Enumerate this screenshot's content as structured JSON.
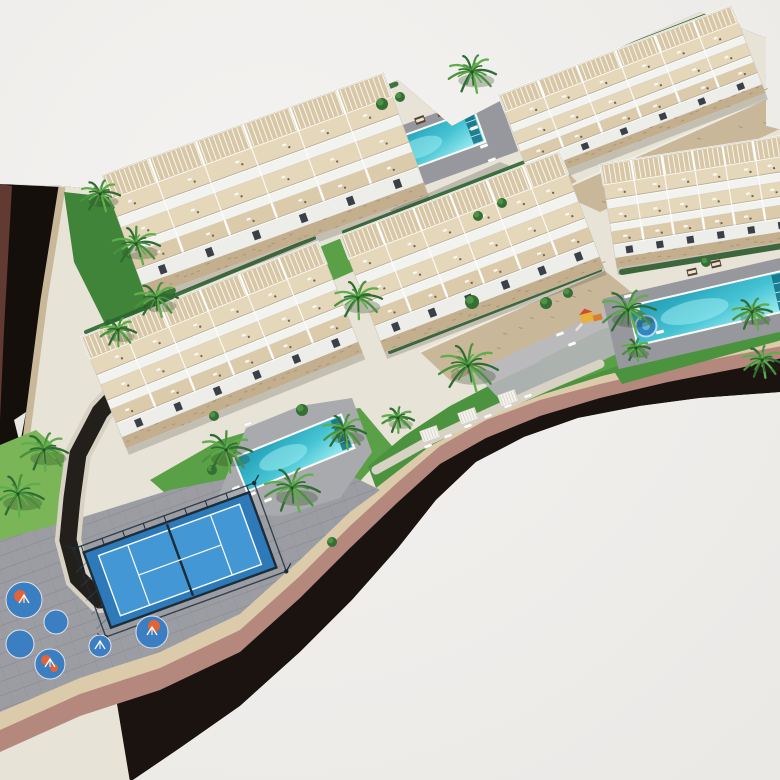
{
  "scene": {
    "canvas": {
      "w": 780,
      "h": 780
    },
    "palette": {
      "bg": "#f4f3f1",
      "bg2": "#ebe9e6",
      "siteBase": "#e8e3d7",
      "asphalt": "#1a1310",
      "mauve": "#b5887e",
      "beige": "#dccbab",
      "stone": "#c9b79a",
      "stoneDark": "#a08e72",
      "stoneCap": "#f0ece2",
      "lawn": "#4c9340",
      "lawnLight": "#7ab557",
      "lawnMid": "#5aa046",
      "hedge": "#2d6630",
      "hedgeStrip": "#3f8438",
      "paving": "#9c9da3",
      "pavingLine": "#84858c",
      "deck": "#97989d",
      "deckLight": "#a9aaae",
      "poolDark": "#1f9ab4",
      "poolMid": "#45c3d3",
      "poolLight": "#a5f0f4",
      "white": "#fbfbf9",
      "pergola": "#d7c7a6",
      "terrace": "#e5d7b9",
      "terrace2": "#dccbab",
      "wall": "#f2f2ef",
      "front": "#ededea",
      "window": "#3b4046",
      "stoneBase": "#c3ae8e",
      "court": "#2e79b8",
      "courtIn": "#4397d4",
      "courtFrame": "#1c2c38",
      "padBlue": "#3b7ec2",
      "padOrange": "#e06438",
      "drive": "#23201c",
      "path": "#d8d2c4",
      "parcel": "#150f0c",
      "parcelEdge": "#6e4238",
      "palmA": "#2f6b33",
      "palmB": "#49903f",
      "palmC": "#5fae4a",
      "trunk": "#8a7155",
      "daybed": "#57432f",
      "playYellow": "#e9b13d",
      "playRed": "#cf4b32",
      "playOrange": "#d87f2f",
      "splash": "#2f86c0",
      "splashIn": "#67b4e0"
    },
    "road": {
      "outer": [
        [
          130,
          782
        ],
        [
          180,
          748
        ],
        [
          240,
          706
        ],
        [
          300,
          652
        ],
        [
          352,
          600
        ],
        [
          398,
          548
        ],
        [
          436,
          500
        ],
        [
          476,
          462
        ],
        [
          524,
          437
        ],
        [
          578,
          418
        ],
        [
          640,
          406
        ],
        [
          700,
          398
        ],
        [
          782,
          392
        ]
      ],
      "asphalt_top": [
        [
          0,
          752
        ],
        [
          80,
          716
        ],
        [
          160,
          690
        ],
        [
          240,
          652
        ],
        [
          300,
          598
        ],
        [
          350,
          548
        ],
        [
          398,
          502
        ],
        [
          440,
          464
        ],
        [
          486,
          438
        ],
        [
          540,
          416
        ],
        [
          600,
          398
        ],
        [
          668,
          382
        ],
        [
          740,
          368
        ],
        [
          782,
          358
        ]
      ],
      "mauve_top": [
        [
          0,
          730
        ],
        [
          80,
          694
        ],
        [
          160,
          668
        ],
        [
          240,
          630
        ],
        [
          300,
          576
        ],
        [
          350,
          526
        ],
        [
          398,
          482
        ],
        [
          440,
          446
        ],
        [
          486,
          420
        ],
        [
          540,
          400
        ],
        [
          600,
          384
        ],
        [
          668,
          368
        ],
        [
          740,
          354
        ],
        [
          782,
          346
        ]
      ],
      "beige_top": [
        [
          0,
          712
        ],
        [
          80,
          678
        ],
        [
          160,
          652
        ],
        [
          240,
          614
        ],
        [
          300,
          560
        ],
        [
          350,
          512
        ],
        [
          398,
          468
        ],
        [
          440,
          434
        ],
        [
          486,
          408
        ],
        [
          540,
          390
        ],
        [
          600,
          374
        ],
        [
          668,
          358
        ],
        [
          740,
          344
        ],
        [
          782,
          336
        ]
      ]
    },
    "site_upper": [
      [
        0,
        184
      ],
      [
        62,
        186
      ],
      [
        118,
        192
      ],
      [
        398,
        80
      ],
      [
        452,
        126
      ],
      [
        506,
        98
      ],
      [
        700,
        12
      ],
      [
        766,
        38
      ],
      [
        766,
        126
      ],
      [
        782,
        130
      ]
    ],
    "parcel": {
      "pts": [
        [
          0,
          184
        ],
        [
          62,
          187
        ],
        [
          44,
          300
        ],
        [
          26,
          440
        ],
        [
          14,
          470
        ],
        [
          0,
          490
        ]
      ],
      "edge": [
        [
          0,
          184
        ],
        [
          12,
          186
        ],
        [
          4,
          330
        ],
        [
          0,
          420
        ]
      ],
      "zigzags": [
        [
          [
            6,
            452
          ],
          [
            20,
            442
          ],
          [
            12,
            472
          ]
        ],
        [
          [
            14,
            420
          ],
          [
            26,
            412
          ],
          [
            20,
            444
          ]
        ]
      ]
    },
    "lawns": [
      {
        "id": "hedge-strip-west",
        "c": "hedgeStrip",
        "pts": [
          [
            64,
            192
          ],
          [
            118,
            198
          ],
          [
            176,
            290
          ],
          [
            160,
            352
          ],
          [
            116,
            346
          ],
          [
            74,
            262
          ]
        ]
      },
      {
        "id": "lawn-wedge-center",
        "c": "lawnMid",
        "pts": [
          [
            160,
            312
          ],
          [
            376,
            224
          ],
          [
            406,
            248
          ],
          [
            194,
            342
          ]
        ]
      },
      {
        "id": "lawn-mound-southwest",
        "c": "lawnLight",
        "pts": [
          [
            0,
            445
          ],
          [
            36,
            430
          ],
          [
            66,
            456
          ],
          [
            74,
            508
          ],
          [
            56,
            560
          ],
          [
            18,
            582
          ],
          [
            0,
            582
          ]
        ]
      },
      {
        "id": "lawn-pool-center",
        "c": "lawnMid",
        "pts": [
          [
            150,
            480
          ],
          [
            220,
            440
          ],
          [
            300,
            416
          ],
          [
            360,
            408
          ],
          [
            392,
            446
          ],
          [
            352,
            490
          ],
          [
            300,
            512
          ],
          [
            240,
            516
          ],
          [
            180,
            506
          ]
        ]
      },
      {
        "id": "lawn-main-south",
        "c": "lawn",
        "pts": [
          [
            376,
            488
          ],
          [
            430,
            446
          ],
          [
            488,
            416
          ],
          [
            544,
            394
          ],
          [
            602,
            376
          ],
          [
            668,
            360
          ],
          [
            740,
            346
          ],
          [
            782,
            338
          ],
          [
            782,
            300
          ],
          [
            720,
            300
          ],
          [
            660,
            316
          ],
          [
            610,
            330
          ],
          [
            560,
            352
          ],
          [
            500,
            380
          ],
          [
            450,
            406
          ],
          [
            404,
            436
          ],
          [
            368,
            466
          ]
        ]
      },
      {
        "id": "lawn-mini-playground",
        "c": "lawnMid",
        "pts": [
          [
            540,
            360
          ],
          [
            600,
            330
          ],
          [
            660,
            312
          ],
          [
            700,
            310
          ],
          [
            712,
            330
          ],
          [
            660,
            352
          ],
          [
            600,
            372
          ],
          [
            552,
            388
          ]
        ]
      },
      {
        "id": "lawn-east-pool",
        "c": "lawn",
        "pts": [
          [
            612,
            368
          ],
          [
            782,
            318
          ],
          [
            782,
            340
          ],
          [
            622,
            384
          ]
        ]
      }
    ],
    "esplanade": [
      [
        0,
        540
      ],
      [
        80,
        518
      ],
      [
        170,
        490
      ],
      [
        262,
        472
      ],
      [
        332,
        466
      ],
      [
        380,
        490
      ],
      [
        350,
        512
      ],
      [
        300,
        560
      ],
      [
        240,
        614
      ],
      [
        160,
        652
      ],
      [
        80,
        678
      ],
      [
        0,
        712
      ]
    ],
    "paved": [
      {
        "id": "courtyard-north",
        "c": "#b7b2a8",
        "pts": [
          [
            390,
            210
          ],
          [
            500,
            162
          ],
          [
            540,
            178
          ],
          [
            430,
            250
          ]
        ]
      },
      {
        "id": "walkway-southeast",
        "c": "#b5b5ba",
        "pts": [
          [
            470,
            368
          ],
          [
            600,
            306
          ],
          [
            648,
            338
          ],
          [
            508,
            408
          ]
        ]
      }
    ],
    "walls": [
      {
        "id": "rubble-wall-1",
        "pts": [
          [
            420,
            220
          ],
          [
            556,
            160
          ],
          [
            580,
            185
          ],
          [
            444,
            248
          ]
        ]
      },
      {
        "id": "rubble-wall-2",
        "pts": [
          [
            556,
            192
          ],
          [
            768,
            98
          ],
          [
            782,
            128
          ],
          [
            600,
            212
          ]
        ]
      },
      {
        "id": "rubble-wall-3",
        "pts": [
          [
            420,
            352
          ],
          [
            604,
            270
          ],
          [
            636,
            296
          ],
          [
            452,
            382
          ]
        ]
      }
    ],
    "hedges": [
      {
        "a": [
          116,
          190
        ],
        "b": [
          396,
          84
        ],
        "w": 5
      },
      {
        "a": [
          500,
          96
        ],
        "b": [
          726,
          8
        ],
        "w": 5
      },
      {
        "a": [
          344,
          232
        ],
        "b": [
          556,
          150
        ],
        "w": 4
      },
      {
        "a": [
          86,
          332
        ],
        "b": [
          314,
          238
        ],
        "w": 4
      },
      {
        "a": [
          622,
          272
        ],
        "b": [
          782,
          246
        ],
        "w": 6
      },
      {
        "a": [
          390,
          352
        ],
        "b": [
          600,
          270
        ],
        "w": 4
      }
    ],
    "driveway": [
      [
        130,
        380
      ],
      [
        100,
        412
      ],
      [
        78,
        454
      ],
      [
        72,
        498
      ],
      [
        68,
        540
      ],
      [
        78,
        578
      ],
      [
        100,
        600
      ]
    ],
    "walkway": {
      "path": [
        [
          376,
          470
        ],
        [
          430,
          440
        ],
        [
          490,
          412
        ],
        [
          548,
          386
        ],
        [
          600,
          364
        ]
      ],
      "squares": [
        [
          430,
          434
        ],
        [
          468,
          416
        ],
        [
          508,
          398
        ]
      ]
    },
    "buildings": [
      {
        "id": "a",
        "cx": 265,
        "cy": 185,
        "w": 300,
        "h": 130,
        "rot": -20
      },
      {
        "id": "b",
        "cx": 632,
        "cy": 94,
        "w": 250,
        "h": 94,
        "rot": -21
      },
      {
        "id": "c",
        "cx": 700,
        "cy": 202,
        "w": 185,
        "h": 105,
        "rot": -9
      },
      {
        "id": "d",
        "cx": 472,
        "cy": 252,
        "w": 235,
        "h": 125,
        "rot": -21
      },
      {
        "id": "e",
        "cx": 222,
        "cy": 345,
        "w": 255,
        "h": 120,
        "rot": -22
      }
    ],
    "pools": [
      {
        "id": "pool-north",
        "deck": {
          "cx": 436,
          "cy": 147,
          "w": 152,
          "h": 64
        },
        "cx": 430,
        "cy": 144,
        "w": 106,
        "h": 34,
        "rot": -20,
        "loungers": [
          [
            474,
            128
          ],
          [
            484,
            146
          ],
          [
            492,
            160
          ],
          [
            380,
            168
          ],
          [
            396,
            176
          ]
        ],
        "daybeds": [
          [
            420,
            120
          ],
          [
            442,
            112
          ]
        ]
      },
      {
        "id": "pool-east",
        "deck": {
          "cx": 706,
          "cy": 312,
          "w": 196,
          "h": 72
        },
        "cx": 710,
        "cy": 308,
        "w": 158,
        "h": 40,
        "rot": -13,
        "loungers": [
          [
            628,
            296
          ],
          [
            636,
            310
          ],
          [
            646,
            322
          ],
          [
            660,
            332
          ]
        ],
        "daybeds": [
          [
            692,
            272
          ],
          [
            716,
            264
          ]
        ]
      },
      {
        "id": "pool-center",
        "deckPts": [
          [
            218,
            497
          ],
          [
            246,
            428
          ],
          [
            300,
            406
          ],
          [
            352,
            398
          ],
          [
            372,
            452
          ],
          [
            340,
            498
          ],
          [
            282,
            516
          ],
          [
            240,
            514
          ]
        ],
        "cx": 294,
        "cy": 453,
        "w": 116,
        "h": 36,
        "rot": -22,
        "loungers": [
          [
            236,
            488
          ],
          [
            252,
            494
          ],
          [
            268,
            500
          ],
          [
            248,
            424
          ]
        ],
        "daybeds": []
      }
    ],
    "padel": {
      "cx": 180,
      "cy": 560,
      "w": 176,
      "h": 80,
      "rot": -20
    },
    "playground": {
      "pads": [
        [
          24,
          600,
          18
        ],
        [
          56,
          622,
          12
        ],
        [
          20,
          644,
          14
        ],
        [
          50,
          664,
          15
        ],
        [
          152,
          632,
          16
        ],
        [
          100,
          646,
          11
        ]
      ],
      "orange": [
        [
          20,
          596,
          6
        ],
        [
          46,
          660,
          5
        ],
        [
          154,
          626,
          6
        ],
        [
          54,
          668,
          4
        ]
      ],
      "marks": [
        [
          24,
          600
        ],
        [
          50,
          664
        ],
        [
          152,
          632
        ],
        [
          100,
          646
        ]
      ]
    },
    "mini_playground": {
      "x": 588,
      "y": 318,
      "splash": [
        646,
        326,
        10.5
      ]
    },
    "loungers_extra": [
      [
        428,
        446
      ],
      [
        448,
        436
      ],
      [
        468,
        426
      ],
      [
        488,
        416
      ],
      [
        508,
        406
      ],
      [
        528,
        396
      ]
    ],
    "palms": [
      [
        100,
        196,
        20
      ],
      [
        136,
        246,
        24
      ],
      [
        156,
        300,
        22
      ],
      [
        118,
        332,
        18
      ],
      [
        44,
        452,
        24
      ],
      [
        18,
        496,
        26
      ],
      [
        226,
        452,
        26
      ],
      [
        292,
        490,
        28
      ],
      [
        344,
        432,
        22
      ],
      [
        398,
        420,
        16
      ],
      [
        358,
        300,
        24
      ],
      [
        472,
        74,
        24
      ],
      [
        468,
        368,
        30
      ],
      [
        628,
        312,
        28
      ],
      [
        752,
        314,
        20
      ],
      [
        762,
        362,
        20
      ],
      [
        636,
        350,
        14
      ]
    ],
    "bushes": [
      [
        382,
        104,
        6
      ],
      [
        400,
        97,
        5
      ],
      [
        546,
        303,
        6
      ],
      [
        568,
        293,
        5
      ],
      [
        472,
        302,
        7
      ],
      [
        302,
        410,
        6
      ],
      [
        212,
        470,
        5
      ],
      [
        332,
        542,
        5
      ],
      [
        478,
        216,
        5
      ],
      [
        502,
        203,
        5
      ],
      [
        706,
        262,
        5
      ],
      [
        214,
        416,
        5
      ]
    ]
  }
}
